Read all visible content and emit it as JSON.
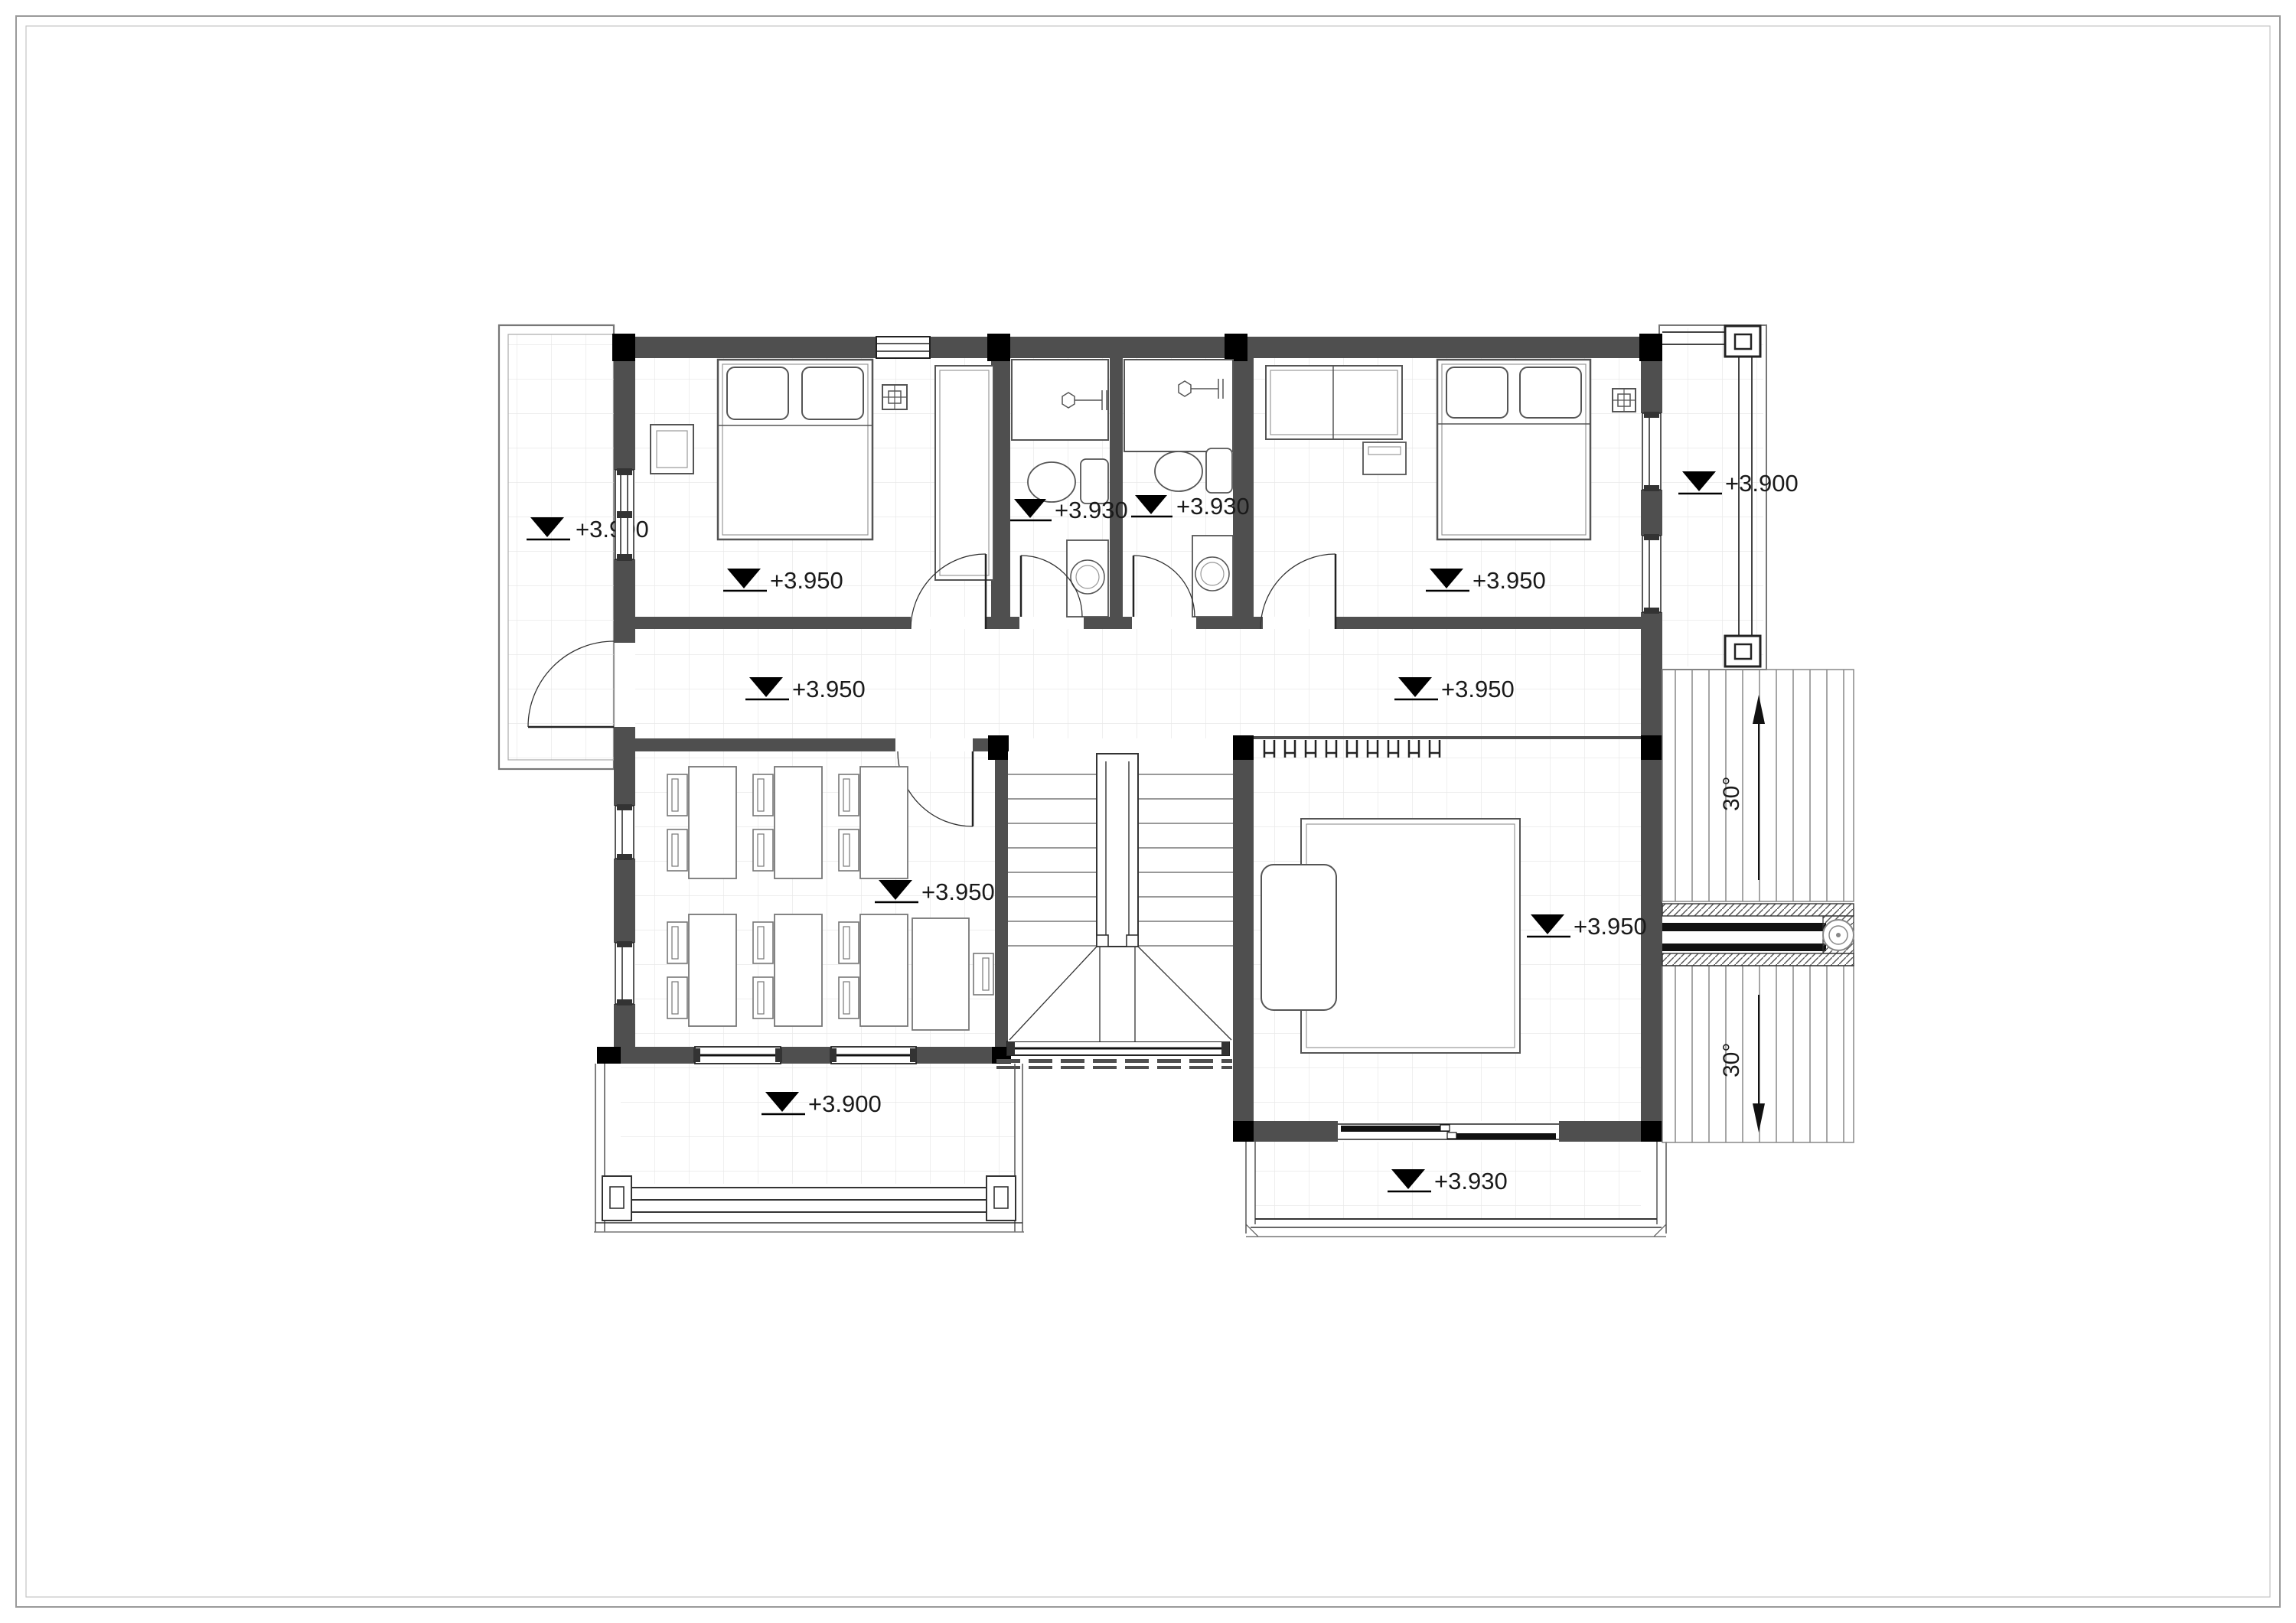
{
  "drawing": {
    "kind": "architectural floor plan, upper storey",
    "wall_color": "#4f4f4f",
    "column_color": "#000000",
    "line_color": "#333333",
    "grid_color": "#e8e8e8"
  },
  "levels": {
    "west_balcony": "+3.900",
    "bedroom_1": "+3.950",
    "bath_1": "+3.930",
    "bath_2": "+3.930",
    "bedroom_2": "+3.950",
    "east_balcony": "+3.900",
    "corridor_west": "+3.950",
    "corridor_east": "+3.950",
    "study_room": "+3.950",
    "master_bedroom": "+3.950",
    "south_terrace": "+3.900",
    "master_balcony": "+3.930"
  },
  "roof": {
    "slope_top": "30°",
    "slope_bottom": "30°"
  }
}
